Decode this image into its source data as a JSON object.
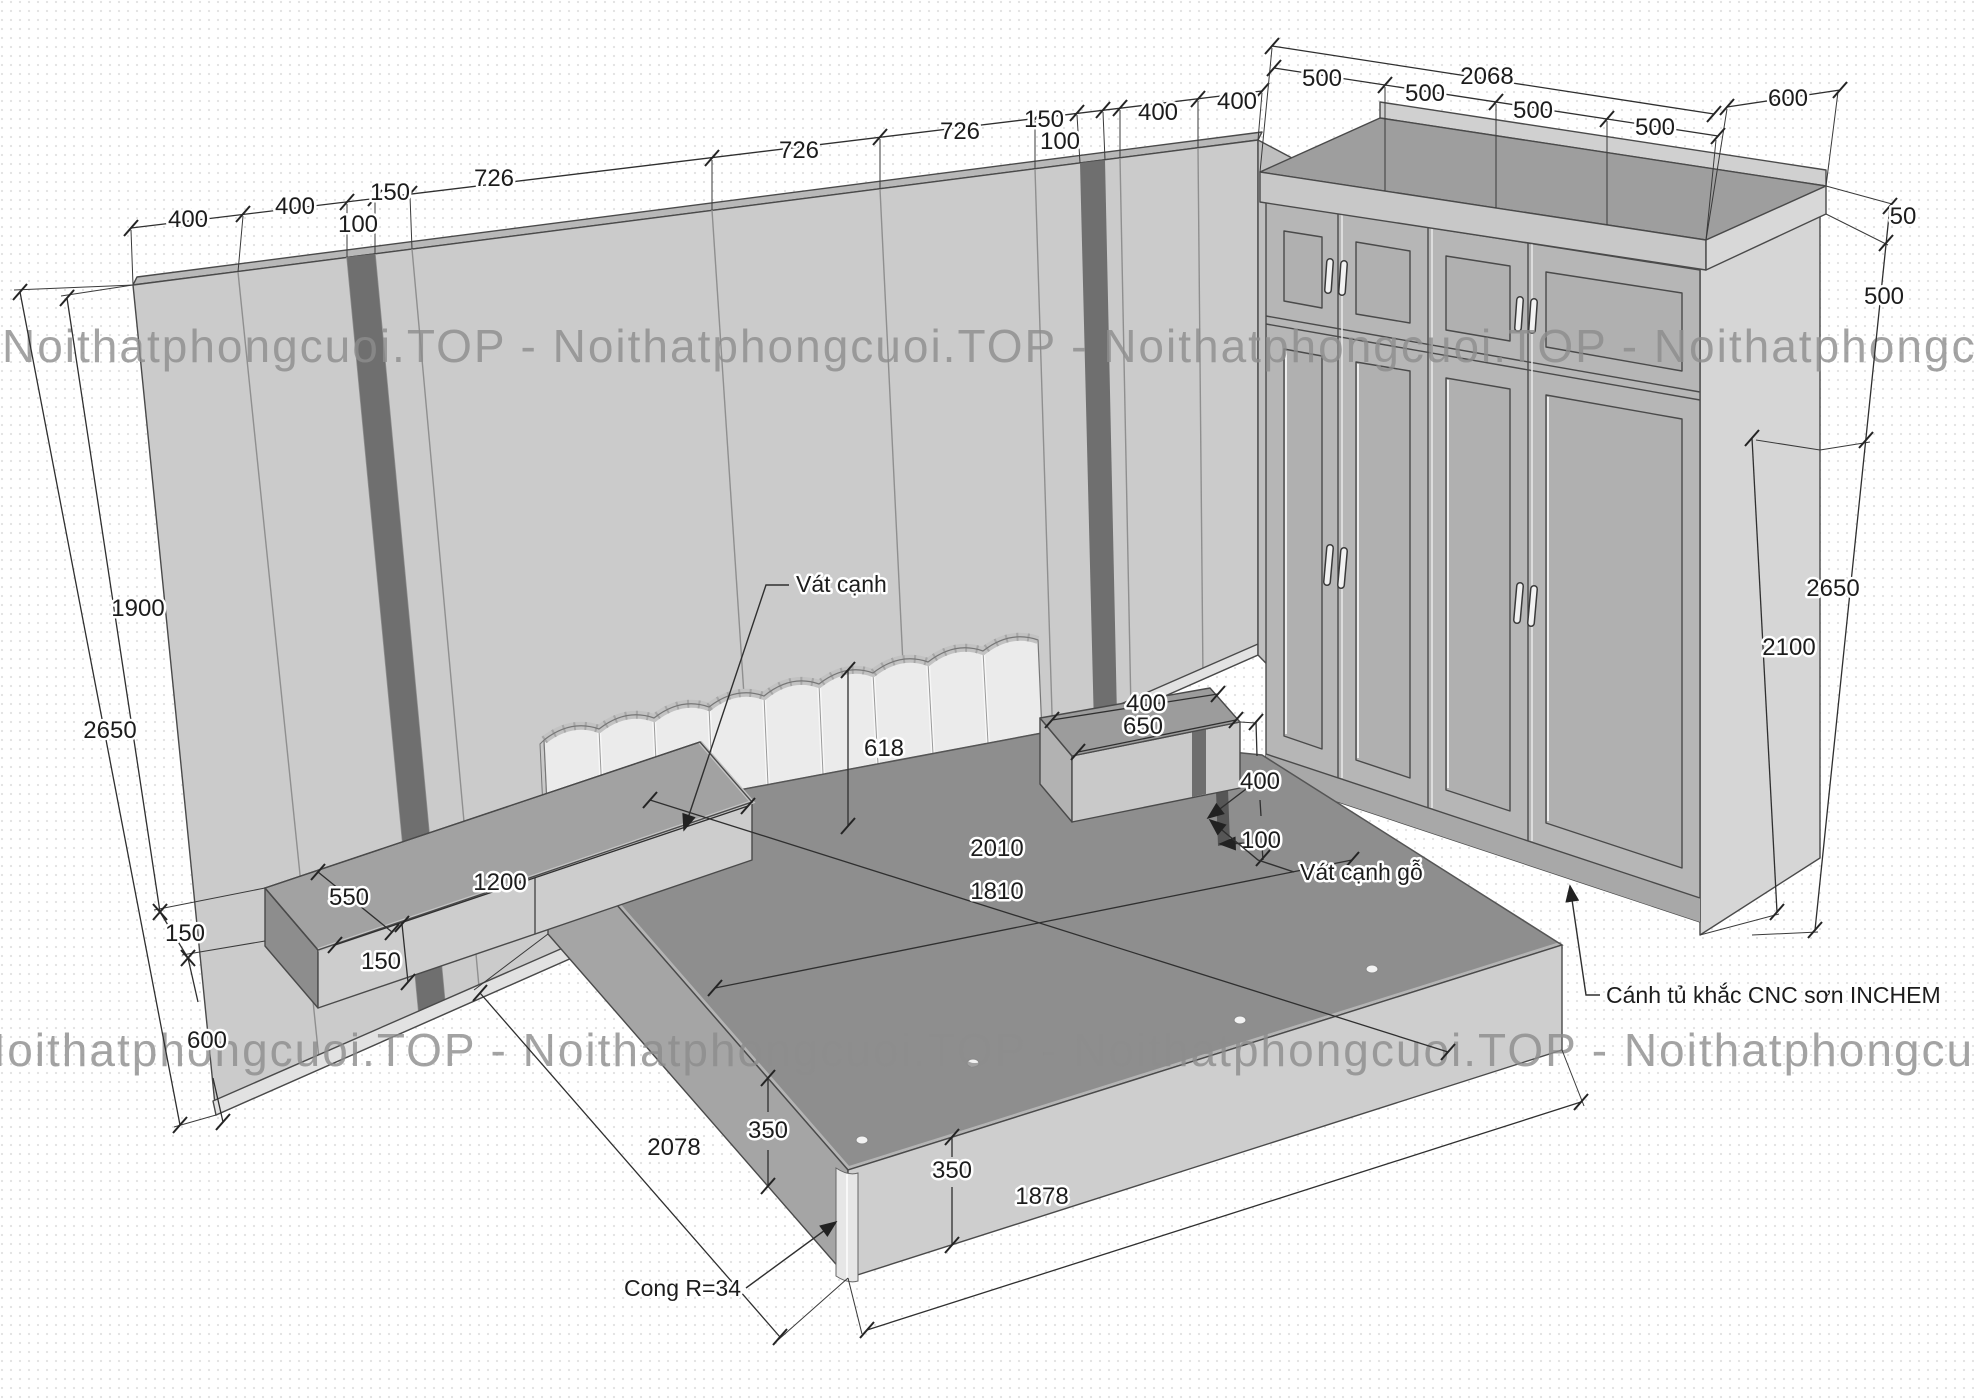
{
  "watermark": {
    "text": "Noithatphongcuoi.TOP - Noithatphongcuoi.TOP - Noithatphongcuoi.TOP - Noithatphongcuoi.TOP",
    "color": "#8d8d8d"
  },
  "colors": {
    "wall": "#cbcbcb",
    "accent_stripe": "#6f6f6f",
    "bed_top": "#8e8e8e",
    "dim_text": "#1c1c1c"
  },
  "dims": {
    "wall_top": {
      "s1": "400",
      "s2": "400",
      "s3": "100",
      "s4": "150",
      "s5": "726",
      "s6": "726",
      "s7": "726",
      "s8": "150",
      "s9": "100",
      "s10": "400",
      "s11": "400"
    },
    "wardrobe_top": {
      "overall": "2068",
      "d1": "500",
      "d2": "500",
      "d3": "500",
      "d4": "500",
      "depth": "600"
    },
    "right": {
      "trim": "50",
      "upper": "500",
      "total": "2650",
      "main": "2100"
    },
    "left": {
      "panel": "1900",
      "total": "2650",
      "desk": "150",
      "below": "600"
    },
    "desk": {
      "depth": "550",
      "length": "1200",
      "thickness": "150"
    },
    "bed": {
      "headboard": "618",
      "length": "2010",
      "width": "1810",
      "h1": "350",
      "h2": "350",
      "base_l": "2078",
      "base_r": "1878"
    },
    "nightstand": {
      "depth": "400",
      "width": "650",
      "height": "400",
      "leg": "100"
    },
    "notes": {
      "chamfer": "Vát cạnh",
      "wood_chamfer": "Vát cạnh gỗ",
      "cnc_door": "Cánh tủ khắc CNC sơn INCHEM",
      "radius": "Cong R=34"
    }
  }
}
